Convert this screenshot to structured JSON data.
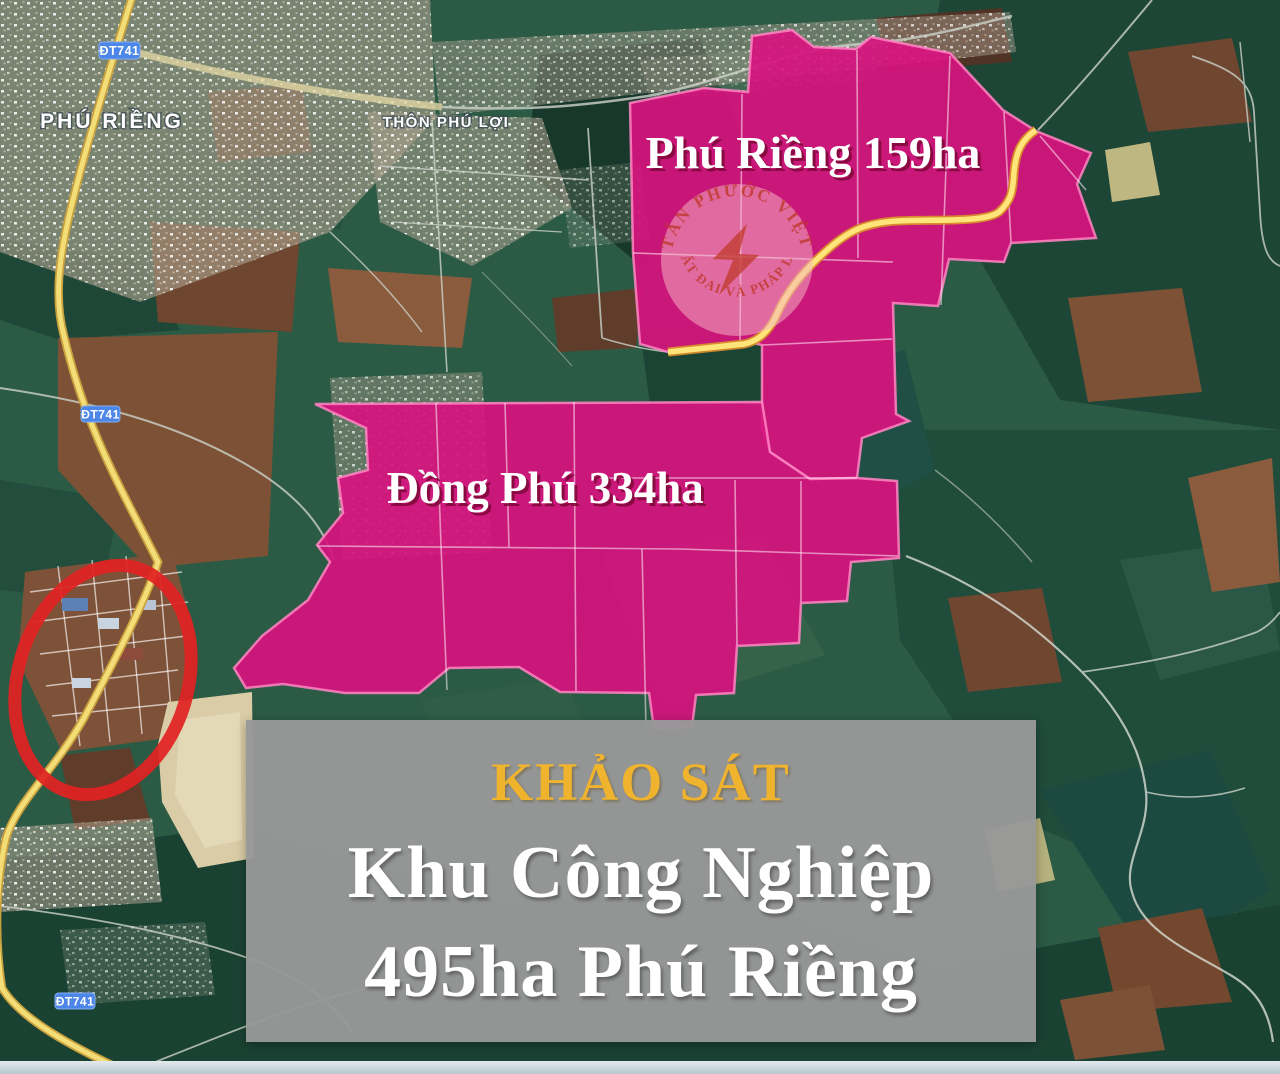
{
  "map": {
    "road_badge": "ĐT741",
    "labels": {
      "town": "PHÚ RIỀNG",
      "village": "THÔN PHÚ LỢI"
    },
    "areas": {
      "phu_rieng": {
        "label": "Phú Riềng 159ha",
        "name": "Phú Riềng",
        "area_ha": 159
      },
      "dong_phu": {
        "label": "Đồng Phú 334ha",
        "name": "Đồng Phú",
        "area_ha": 334
      }
    },
    "highlight_color": "#d6137e",
    "route_yellow": "#f3dd76",
    "red_circle_color": "#e02222",
    "badge_blue": "#4b86e8"
  },
  "watermark": {
    "arc_top": "TÂN PHƯỚC VIỆT",
    "arc_bottom": "ĐẤT ĐAI VÀ PHÁP LÝ"
  },
  "banner": {
    "title": "KHẢO SÁT",
    "line1": "Khu Công Nghiệp",
    "line2": "495ha Phú Riềng",
    "title_color": "#f0b32e",
    "bg_color": "#989898"
  }
}
